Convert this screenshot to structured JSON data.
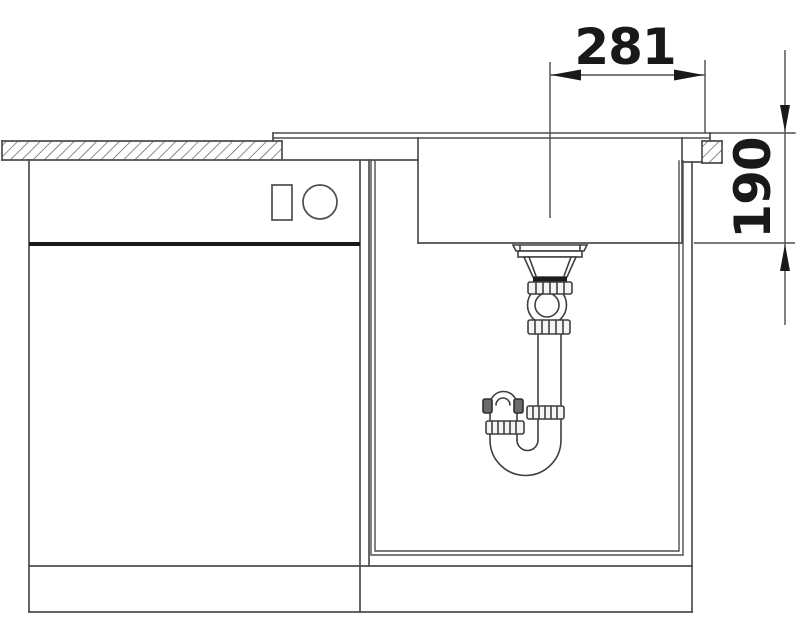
{
  "drawing": {
    "dimensions": {
      "horizontal": {
        "label": "281"
      },
      "vertical": {
        "label": "190"
      }
    },
    "colors": {
      "line": "#4d4d4d",
      "accent_dark": "#191919",
      "background": "#ffffff"
    }
  }
}
